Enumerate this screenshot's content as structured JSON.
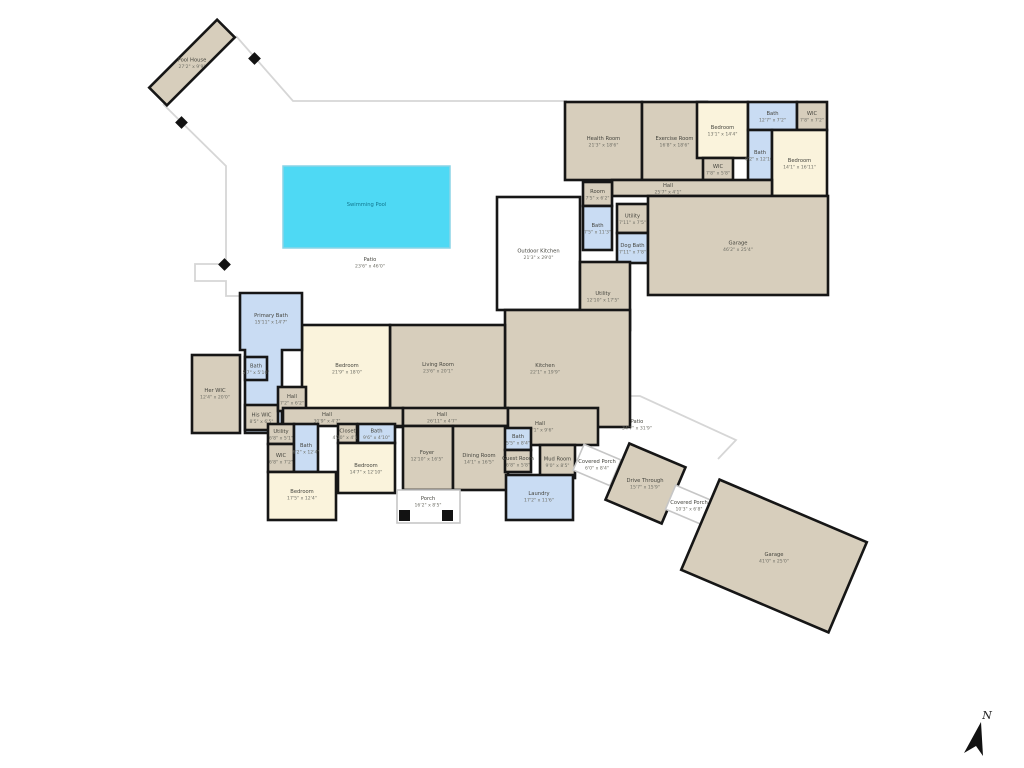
{
  "compass": {
    "label": "N"
  },
  "palette": {
    "wall": "#161616",
    "room_tan": "#d7cebc",
    "bedroom_cream": "#faf3dc",
    "bath_blue": "#c9dcf3",
    "pool_cyan": "#4ed9f4",
    "outdoor_white": "#ffffff",
    "boundary_gray": "#d6d6d6"
  },
  "rooms": [
    {
      "id": "pool-house",
      "label": "Pool House",
      "dims": "27'2\" x 9'9\""
    },
    {
      "id": "swimming-pool",
      "label": "Swimming Pool",
      "dims": ""
    },
    {
      "id": "patio-pool",
      "label": "Patio",
      "dims": "23'6\" x 46'0\""
    },
    {
      "id": "health-room",
      "label": "Health Room",
      "dims": "21'3\" x 18'6\""
    },
    {
      "id": "exercise-room",
      "label": "Exercise Room",
      "dims": "16'8\" x 18'6\""
    },
    {
      "id": "bedroom-1",
      "label": "Bedroom",
      "dims": "13'1\" x 14'4\""
    },
    {
      "id": "wic-1",
      "label": "WIC",
      "dims": "7'8\" x 5'8\""
    },
    {
      "id": "bath-1",
      "label": "Bath",
      "dims": "12'7\" x 7'2\""
    },
    {
      "id": "wic-2",
      "label": "WIC",
      "dims": "7'8\" x 7'2\""
    },
    {
      "id": "bath-2",
      "label": "Bath",
      "dims": "6'2\" x 12'10\""
    },
    {
      "id": "bedroom-2",
      "label": "Bedroom",
      "dims": "14'1\" x 16'11\""
    },
    {
      "id": "hall-1",
      "label": "Hall",
      "dims": "25'7\" x 4'1\""
    },
    {
      "id": "room",
      "label": "Room",
      "dims": "7'5\" x 6'2\""
    },
    {
      "id": "bath-3",
      "label": "Bath",
      "dims": "7'5\" x 11'3\""
    },
    {
      "id": "utility-1",
      "label": "Utility",
      "dims": "7'11\" x 7'5\""
    },
    {
      "id": "dog-bath",
      "label": "Dog Bath",
      "dims": "7'11\" x 7'8\""
    },
    {
      "id": "garage-attached",
      "label": "Garage",
      "dims": "46'2\" x 25'4\""
    },
    {
      "id": "outdoor-kitchen",
      "label": "Outdoor Kitchen",
      "dims": "21'3\" x 29'0\""
    },
    {
      "id": "utility-2",
      "label": "Utility",
      "dims": "12'10\" x 17'5\""
    },
    {
      "id": "kitchen",
      "label": "Kitchen",
      "dims": "22'1\" x 19'9\""
    },
    {
      "id": "living-room",
      "label": "Living Room",
      "dims": "23'6\" x 20'1\""
    },
    {
      "id": "bedroom-primary",
      "label": "Bedroom",
      "dims": "21'9\" x 18'0\""
    },
    {
      "id": "primary-bath",
      "label": "Primary Bath",
      "dims": "15'11\" x 14'7\""
    },
    {
      "id": "bath-4",
      "label": "Bath",
      "dims": "5'7\" x 5'10\""
    },
    {
      "id": "her-wic",
      "label": "Her WIC",
      "dims": "12'4\" x 20'0\""
    },
    {
      "id": "his-wic",
      "label": "His WIC",
      "dims": "8'5\" x 6'5\""
    },
    {
      "id": "hall-2",
      "label": "Hall",
      "dims": "7'2\" x 6'2\""
    },
    {
      "id": "hall-3",
      "label": "Hall",
      "dims": "30'9\" x 4'7\""
    },
    {
      "id": "utility-3",
      "label": "Utility",
      "dims": "6'8\" x 5'1\""
    },
    {
      "id": "wic-3",
      "label": "WIC",
      "dims": "6'8\" x 7'2\""
    },
    {
      "id": "bath-5",
      "label": "Bath",
      "dims": "6'2\" x 12'4\""
    },
    {
      "id": "bedroom-3",
      "label": "Bedroom",
      "dims": "17'5\" x 12'4\""
    },
    {
      "id": "closet",
      "label": "Closet",
      "dims": "4'10\" x 4'10\""
    },
    {
      "id": "bath-6",
      "label": "Bath",
      "dims": "9'6\" x 4'10\""
    },
    {
      "id": "bedroom-4",
      "label": "Bedroom",
      "dims": "14'7\" x 12'10\""
    },
    {
      "id": "hall-4",
      "label": "Hall",
      "dims": "26'11\" x 4'7\""
    },
    {
      "id": "foyer",
      "label": "Foyer",
      "dims": "12'10\" x 16'5\""
    },
    {
      "id": "dining-room",
      "label": "Dining Room",
      "dims": "14'1\" x 16'5\""
    },
    {
      "id": "porch",
      "label": "Porch",
      "dims": "16'2\" x 8'5\""
    },
    {
      "id": "hall-5",
      "label": "Hall",
      "dims": "23'1\" x 9'6\""
    },
    {
      "id": "bath-7",
      "label": "Bath",
      "dims": "5'5\" x 8'4\""
    },
    {
      "id": "guest-room",
      "label": "Guest Room",
      "dims": "6'8\" x 5'8\""
    },
    {
      "id": "mud-room",
      "label": "Mud Room",
      "dims": "9'0\" x 8'5\""
    },
    {
      "id": "laundry",
      "label": "Laundry",
      "dims": "17'2\" x 11'6\""
    },
    {
      "id": "covered-porch-1",
      "label": "Covered Porch",
      "dims": "6'0\" x 8'4\""
    },
    {
      "id": "drive-through",
      "label": "Drive Through",
      "dims": "15'7\" x 15'9\""
    },
    {
      "id": "covered-porch-2",
      "label": "Covered Porch",
      "dims": "10'3\" x 6'8\""
    },
    {
      "id": "garage-detached",
      "label": "Garage",
      "dims": "41'0\" x 25'0\""
    },
    {
      "id": "patio-drive",
      "label": "Patio",
      "dims": "34'7\" x 31'9\""
    }
  ]
}
